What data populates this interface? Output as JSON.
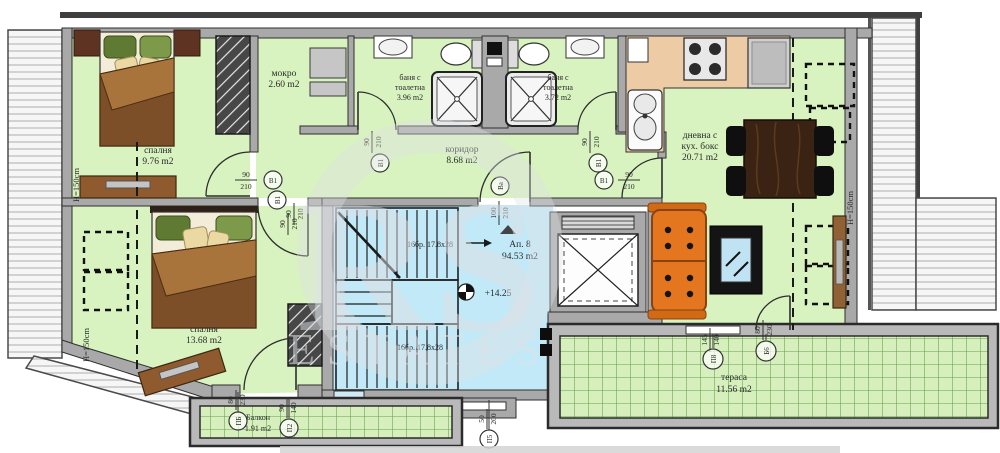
{
  "apartment": {
    "name": "Ап. 8",
    "area": "94.53 m2",
    "level": "+14.25"
  },
  "rooms": {
    "bedroom1": {
      "l1": "спалня",
      "l2": "9.76 m2"
    },
    "mokro": {
      "l1": "мокро",
      "l2": "2.60 m2"
    },
    "bath1": {
      "l1": "баня с",
      "l2": "тоалетна",
      "l3": "3.96 m2"
    },
    "bath2": {
      "l1": "баня с",
      "l2": "тоалетна",
      "l3": "3.72 m2"
    },
    "corridor": {
      "l1": "коридор",
      "l2": "8.68 m2"
    },
    "living": {
      "l1": "дневна с",
      "l2": "кух. бокс",
      "l3": "20.71 m2"
    },
    "bedroom2": {
      "l1": "спалня",
      "l2": "13.68 m2"
    },
    "balcony": {
      "l1": "Балкон",
      "l2": "1.91 m2"
    },
    "terrace": {
      "l1": "тераса",
      "l2": "11.56 m2"
    }
  },
  "stairs": {
    "flight_up": "16бр. 17.8x28",
    "flight_down": "16бр. 17.8x28"
  },
  "notes": {
    "height": "H=150cm"
  },
  "door_marks": {
    "b1": {
      "tag": "В1",
      "w": "90",
      "h": "210"
    },
    "ba": {
      "tag": "Ва",
      "w": "100",
      "h": "210"
    },
    "pb": {
      "tag": "ПБ",
      "w": "80",
      "h": "230"
    },
    "p2": {
      "tag": "П2",
      "w": "90",
      "h": "140"
    },
    "p8": {
      "tag": "П8",
      "w": "145",
      "h": "140"
    },
    "b6": {
      "tag": "Б6",
      "w": "80",
      "h": "230"
    },
    "p5": {
      "tag": "П5",
      "w": "50",
      "h": "200"
    }
  },
  "watermark": {
    "line1": "RS",
    "line2": "ESTATES"
  },
  "colors": {
    "room_fill": "#d8f2c0",
    "stair_fill": "#c2e9f7",
    "terrace_fill": "#d6efbd",
    "wall": "#a9a9a9",
    "kitchen_counter": "#edcba4",
    "sofa_orange": "#e3761f",
    "bed_blanket": "#7d4f28",
    "grid_line": "#61a04c"
  }
}
